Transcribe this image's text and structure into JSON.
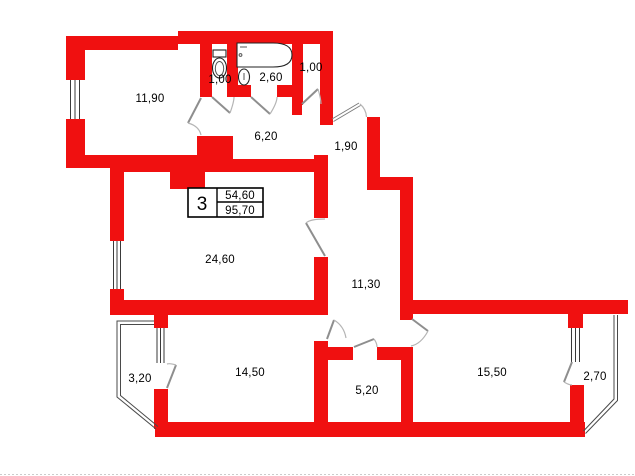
{
  "plan": {
    "info_box": {
      "number": "3",
      "living_area": "54,60",
      "total_area": "95,70"
    },
    "rooms": [
      {
        "name": "room-top-left",
        "area": "11,90"
      },
      {
        "name": "wc",
        "area": "1,00"
      },
      {
        "name": "bathroom",
        "area": "2,60"
      },
      {
        "name": "closet",
        "area": "1,00"
      },
      {
        "name": "hallway",
        "area": "6,20"
      },
      {
        "name": "entry-corridor",
        "area": "1,90"
      },
      {
        "name": "living-room",
        "area": "24,60"
      },
      {
        "name": "corridor",
        "area": "11,30"
      },
      {
        "name": "balcony-left",
        "area": "3,20"
      },
      {
        "name": "bedroom",
        "area": "14,50"
      },
      {
        "name": "kitchen",
        "area": "5,20"
      },
      {
        "name": "room-right",
        "area": "15,50"
      },
      {
        "name": "balcony-right",
        "area": "2,70"
      }
    ],
    "colors": {
      "wall": "#f01010",
      "line": "#3a3a3a",
      "text": "#000000"
    }
  }
}
